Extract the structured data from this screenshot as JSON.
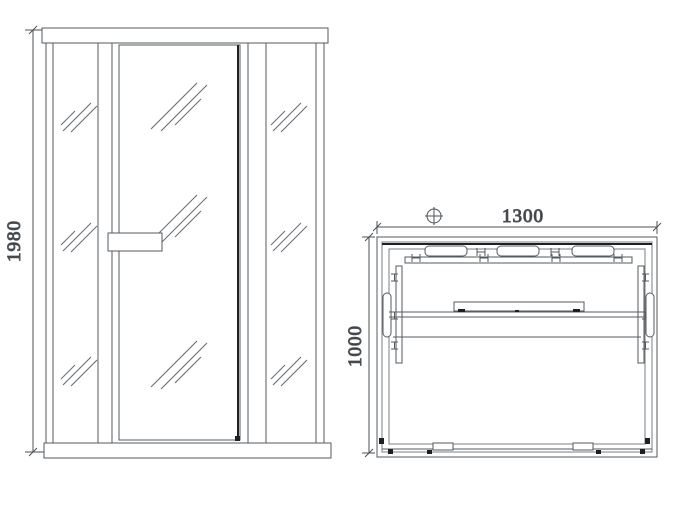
{
  "canvas": {
    "width": 698,
    "height": 514,
    "background": "#ffffff"
  },
  "colors": {
    "line": "#565b61",
    "line_dark": "#1f1f1f",
    "dimension_text": "#3a3a3a"
  },
  "labels": {
    "front_height": "1980",
    "plan_width": "1300",
    "plan_depth": "1000"
  },
  "symbols": {
    "datum_symbol": "crosshair-circle"
  },
  "views": {
    "front_elevation": {
      "name": "front-elevation",
      "parts": [
        "top-rail",
        "left-glass-panel",
        "glass-door",
        "door-handle",
        "right-glass-panel",
        "bottom-rail"
      ],
      "dimensions": [
        {
          "label": "1980",
          "axis": "vertical"
        }
      ]
    },
    "plan_view": {
      "name": "plan-view",
      "parts": [
        "backrest-cushions",
        "back-bench-board",
        "side-panel-left",
        "side-panel-right",
        "wall-grip-left",
        "wall-grip-right",
        "bench-front-edge",
        "center-shelf",
        "door-track-rollers"
      ],
      "dimensions": [
        {
          "label": "1300",
          "axis": "horizontal"
        },
        {
          "label": "1000",
          "axis": "vertical"
        }
      ]
    }
  }
}
